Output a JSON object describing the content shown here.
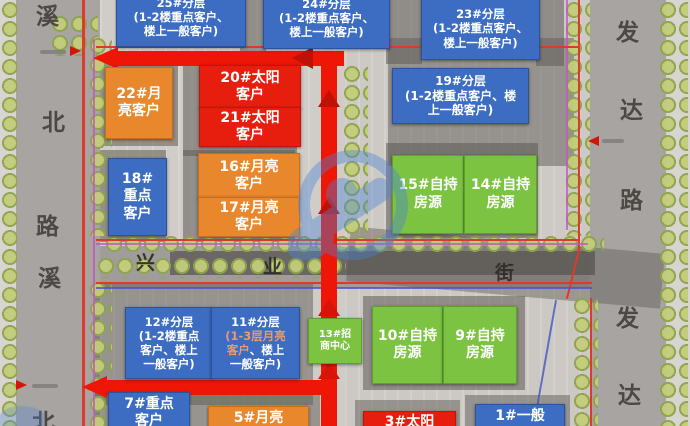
{
  "map_title": "residential-commercial site marketing zoning plan",
  "roads": {
    "left": {
      "name": "溪北路",
      "chars": [
        "溪",
        "北",
        "路",
        "溪",
        "北"
      ]
    },
    "right": {
      "name": "发达路",
      "chars": [
        "发",
        "达",
        "路",
        "发",
        "达"
      ]
    },
    "middle": {
      "name": "兴业街",
      "chars": [
        "兴",
        "业",
        "街"
      ]
    }
  },
  "boxes": {
    "b25": {
      "l1": "25#分层",
      "l2": "(1-2楼重点客户、",
      "l3": "楼上一般客户)"
    },
    "b24": {
      "l1": "24#分层",
      "l2": "(1-2楼重点客户、",
      "l3": "楼上一般客户)"
    },
    "b23": {
      "l1": "23#分层",
      "l2": "(1-2楼重点客户、",
      "l3": "楼上一般客户)"
    },
    "b19": {
      "l1": "19#分层",
      "l2": "(1-2楼重点客户、楼",
      "l3": "上一般客户)"
    },
    "b22": {
      "l1": "22#月",
      "l2": "亮客户"
    },
    "b20": {
      "l1": "20#太阳",
      "l2": "客户"
    },
    "b21": {
      "l1": "21#太阳",
      "l2": "客户"
    },
    "b18": {
      "l1": "18#",
      "l2": "重点",
      "l3": "客户"
    },
    "b16": {
      "l1": "16#月亮",
      "l2": "客户"
    },
    "b17": {
      "l1": "17#月亮",
      "l2": "客户"
    },
    "b15": {
      "l1": "15#自持",
      "l2": "房源"
    },
    "b14": {
      "l1": "14#自持",
      "l2": "房源"
    },
    "b12": {
      "l1": "12#分层",
      "l2": "(1-2楼重点",
      "l3": "客户、楼上",
      "l4": "一般客户)"
    },
    "b11": {
      "l1": "11#分层",
      "l2": "(1-3层月亮",
      "l3a": "客户",
      "l3b": "、楼上",
      "l4": "一般客户)"
    },
    "b13": {
      "l1": "13#招",
      "l2": "商中心"
    },
    "b10": {
      "l1": "10#自持",
      "l2": "房源"
    },
    "b9": {
      "l1": "9#自持",
      "l2": "房源"
    },
    "b7": {
      "l1": "7#重点",
      "l2": "客户"
    },
    "b5": {
      "l1": "5#月亮"
    },
    "b3": {
      "l1": "3#太阳"
    },
    "b1": {
      "l1": "1#一般"
    }
  },
  "colors": {
    "segment_blue": "#3c6dc3",
    "segment_orange": "#e8872c",
    "segment_red": "#e71e0d",
    "segment_green": "#7cc342",
    "route_red": "#ee1607",
    "boundary_red": "#e0392b",
    "highlight_orange_text": "#eb9b68",
    "watermark_blue": "#4a84d6"
  }
}
